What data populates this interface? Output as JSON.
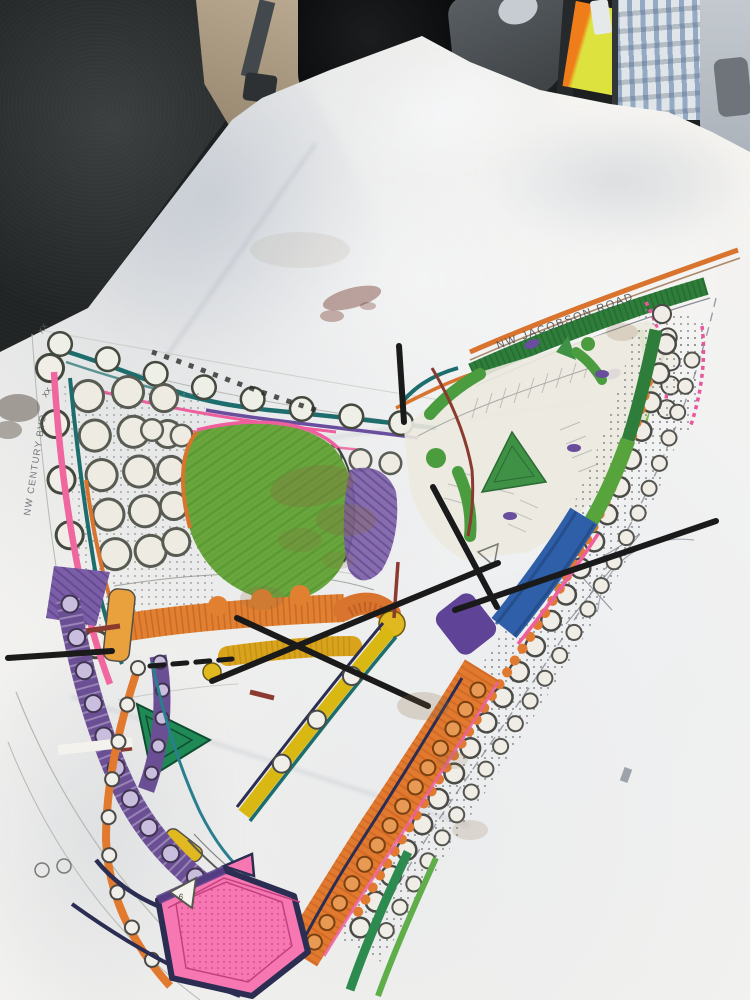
{
  "plan": {
    "labels": {
      "road_top": "NW JACOBSON ROAD",
      "road_left": "NW CENTURY BVD"
    },
    "annotations": {
      "triangle_note": "6",
      "fence_mark_1": "XX",
      "fence_mark_2": "XX"
    },
    "palette": {
      "lawn_green": "#69a63d",
      "island_green": "#3f9146",
      "median_green": "#2f7d3a",
      "amphitheater_green": "#1f8a55",
      "road_orange": "#d8742e",
      "buffer_orange": "#e1792f",
      "structure_orange": "#e08030",
      "promenade_yellow": "#d9b814",
      "swale_blue": "#2f5fa8",
      "walkway_purple": "#6b4f94",
      "pond_pink": "#f777b3",
      "edge_pink": "#ef5f9d",
      "boundary_teal": "#1d6d6d",
      "annotation_black": "#1a1a1a",
      "connector_maroon": "#8b3a2f"
    }
  },
  "vehicle": {
    "vest_yellow": "#dde23f",
    "vest_orange": "#ef7d1a",
    "seat_dark": "#26292a",
    "seat_tan": "#b2a188"
  }
}
